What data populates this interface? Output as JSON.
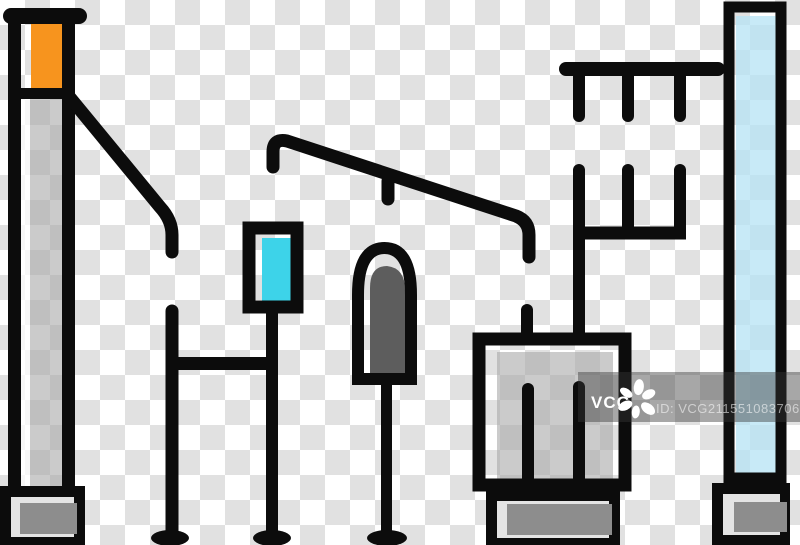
{
  "image": {
    "kind": "stock-preview",
    "subject": "electric substation equipment color line icons",
    "width": 800,
    "height": 545
  },
  "background": {
    "pattern": "transparency-checkerboard",
    "square_px": 25
  },
  "colors": {
    "ink": "#0c0c0c",
    "orange": "#f7941e",
    "cyan": "#3dd3e9",
    "light-blue": "rgba(182,227,244,0.75)",
    "gray-fill": "rgba(168,168,168,0.60)",
    "white-strip": "rgba(255,255,255,0.72)",
    "gray-dark": "#8d8d8d",
    "dome-gray": "#5d5d5d",
    "pedestal-light": "#e4e4e4",
    "checker-dark": "#e1e1e1",
    "checker-light": "#ffffff",
    "band": "rgba(55,55,55,0.44)",
    "wm-text": "#ffffff",
    "wm-id": "rgba(255,255,255,0.55)"
  },
  "watermark": {
    "brand": "VCG",
    "id": "ID: VCG211551083706",
    "logo": "vcg-flower-icon"
  },
  "parts": [
    {
      "name": "signal-mast-icon",
      "desc": "tall post with orange lamp, gray shaft and pedestal base"
    },
    {
      "name": "guy-wire-icon",
      "desc": "diagonal brace from mast"
    },
    {
      "name": "cyan-sign-icon",
      "desc": "framed cyan panel on two legs with crossbar and oval feet"
    },
    {
      "name": "overhead-cable-icon",
      "desc": "bent cable with hanging stub"
    },
    {
      "name": "dome-sensor-icon",
      "desc": "arched dome with dark core on a pole with oval foot"
    },
    {
      "name": "transformer-box-icon",
      "desc": "square cabinet with two bushings, inner rods and pedestal"
    },
    {
      "name": "insulator-rack-icon",
      "desc": "top rail with three hanging insulators and trident frame"
    },
    {
      "name": "glass-column-icon",
      "desc": "tall light-blue panel with pedestal base"
    }
  ]
}
